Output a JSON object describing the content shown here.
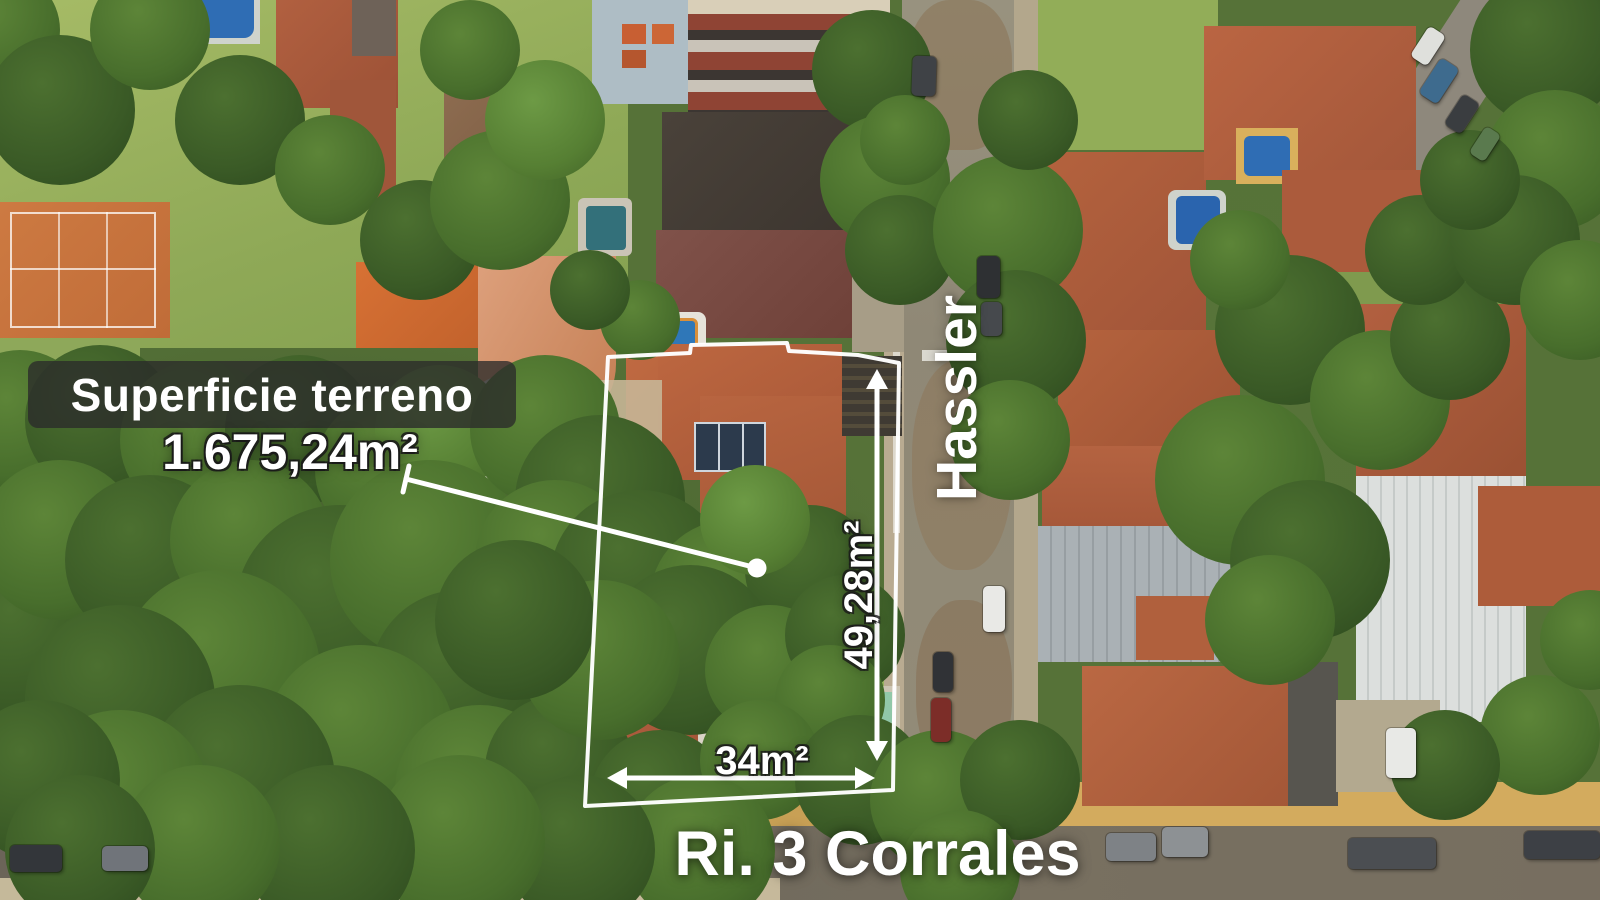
{
  "image": {
    "type": "aerial-drone-photo",
    "description": "Aerial view of a residential block with a highlighted property lot outlined in white, real-estate listing overlay"
  },
  "overlay": {
    "area_panel": {
      "title": "Superficie terreno"
    },
    "area_value": "1.675,24m²",
    "streets": {
      "vertical": "Hassler",
      "horizontal": "Ri. 3 Corrales"
    },
    "measurements": {
      "depth": "49,28m²",
      "frontage": "34m²"
    }
  },
  "colors": {
    "annotation_white": "#ffffff",
    "panel_background": "rgba(42,42,42,0.78)",
    "roof_terracotta": "#b0603d",
    "vegetation_green": "#486e2c",
    "lawn_green": "#9cb261",
    "pool_blue": "#2a64ae",
    "pool_green": "#93c8a9",
    "street_gray": "#96907f",
    "street_dark": "#6f685c",
    "sidewalk_yellow": "#c8a055",
    "clay_court_orange": "#c9763f"
  }
}
